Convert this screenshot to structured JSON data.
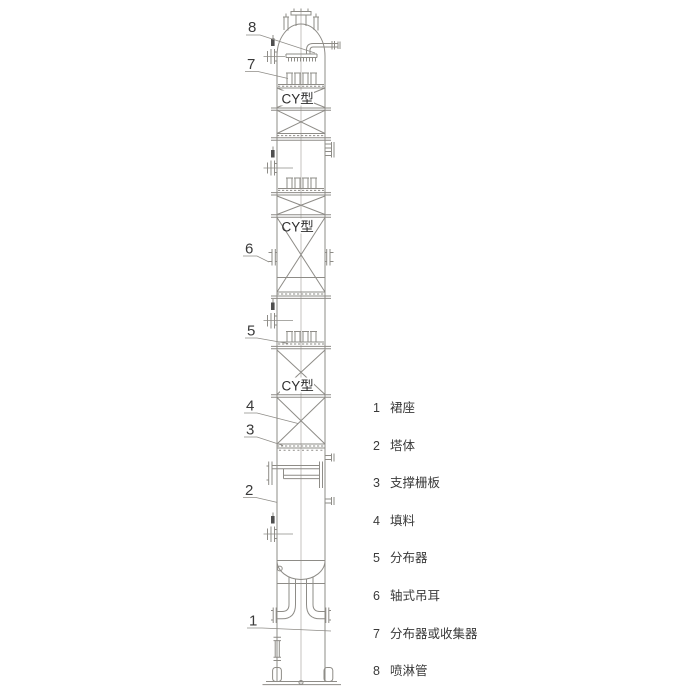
{
  "diagram": {
    "packing_labels": [
      "CY型",
      "CY型",
      "CY型"
    ],
    "callouts": [
      {
        "number": "8"
      },
      {
        "number": "7"
      },
      {
        "number": "6"
      },
      {
        "number": "5"
      },
      {
        "number": "4"
      },
      {
        "number": "3"
      },
      {
        "number": "2"
      },
      {
        "number": "1"
      }
    ],
    "legend": {
      "items": [
        {
          "number": "1",
          "label": "裙座"
        },
        {
          "number": "2",
          "label": "塔体"
        },
        {
          "number": "3",
          "label": "支撑栅板"
        },
        {
          "number": "4",
          "label": "填料"
        },
        {
          "number": "5",
          "label": "分布器"
        },
        {
          "number": "6",
          "label": "轴式吊耳"
        },
        {
          "number": "7",
          "label": "分布器或收集器"
        },
        {
          "number": "8",
          "label": "喷淋管"
        }
      ]
    },
    "colors": {
      "line": "#8e8c87",
      "text": "#3a3a3a"
    }
  }
}
